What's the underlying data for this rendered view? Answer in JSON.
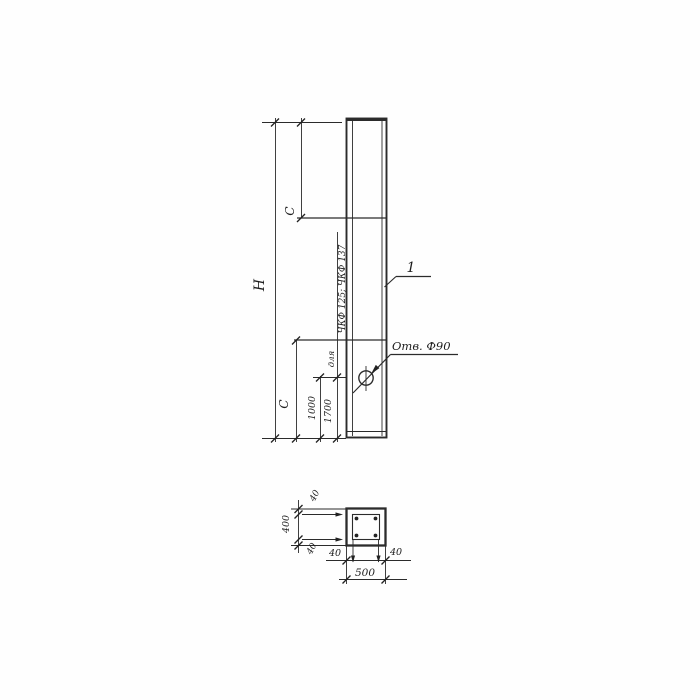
{
  "page": {
    "background": "#fefefe",
    "ink_color": "#2b2b2b",
    "kind": "engineering drawing — reinforced concrete post, elevation and cross-section"
  },
  "elevation": {
    "height_label": "Н",
    "c_top_label": "С",
    "c_bottom_label": "С",
    "dim_1000": "1000",
    "dim_1700": "1700",
    "note_for": "для",
    "note_series": "ЧКФ 125; ЧКФ 137",
    "item_label": "1",
    "hole_label": "Отв. Ф90"
  },
  "section": {
    "overall_width": "500",
    "overall_height": "400",
    "cover_top": "40",
    "cover_bottom": "40",
    "cover_left": "40",
    "cover_right": "40"
  }
}
